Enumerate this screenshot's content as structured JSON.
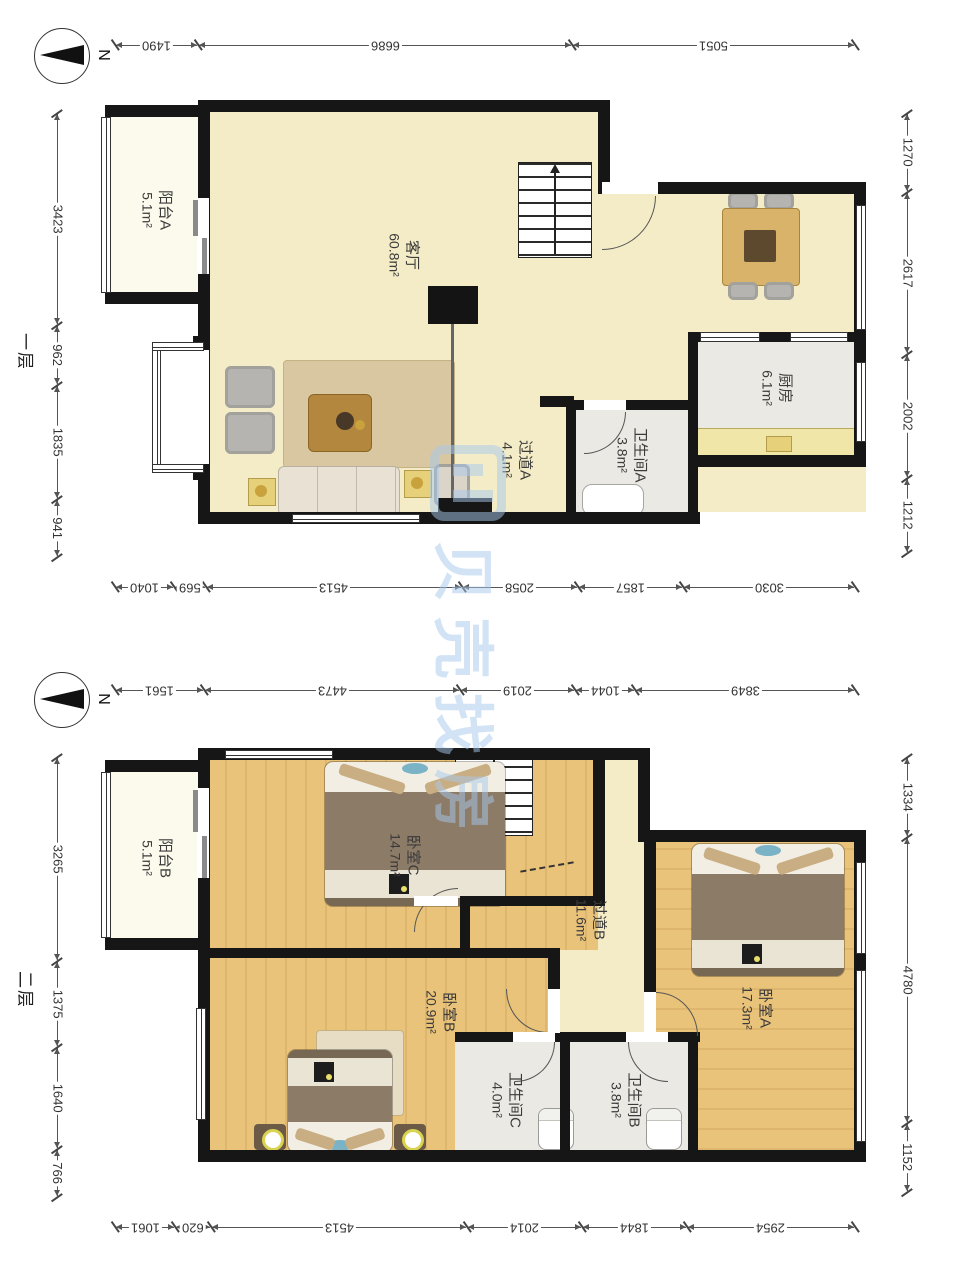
{
  "compass_label": "N",
  "watermark": {
    "text": "贝壳找房"
  },
  "floor1": {
    "label": "一层",
    "rooms": [
      {
        "name": "客厅",
        "area": "60.8m²"
      },
      {
        "name": "厨房",
        "area": "6.1m²"
      },
      {
        "name": "卫生间A",
        "area": "3.8m²"
      },
      {
        "name": "过道A",
        "area": "4.1m²"
      },
      {
        "name": "阳台A",
        "area": "5.1m²"
      }
    ],
    "dims": {
      "top": [
        1490,
        6686,
        5051
      ],
      "bottom": [
        1040,
        569,
        4513,
        2058,
        1857,
        3030
      ],
      "left": [
        3423,
        962,
        1835,
        941
      ],
      "right": [
        1270,
        2617,
        2002,
        1212
      ]
    }
  },
  "floor2": {
    "label": "二层",
    "rooms": [
      {
        "name": "卧室C",
        "area": "14.7m²"
      },
      {
        "name": "卧室A",
        "area": "17.3m²"
      },
      {
        "name": "卧室B",
        "area": "20.9m²"
      },
      {
        "name": "过道B",
        "area": "11.6m²"
      },
      {
        "name": "卫生间C",
        "area": "4.0m²"
      },
      {
        "name": "卫生间B",
        "area": "3.8m²"
      },
      {
        "name": "阳台B",
        "area": "5.1m²"
      }
    ],
    "dims": {
      "top": [
        1561,
        4473,
        2019,
        1044,
        3849
      ],
      "bottom": [
        1061,
        620,
        4513,
        2014,
        1844,
        2954
      ],
      "left": [
        3265,
        1375,
        1640,
        766
      ],
      "right": [
        1334,
        4780,
        1152
      ]
    }
  }
}
